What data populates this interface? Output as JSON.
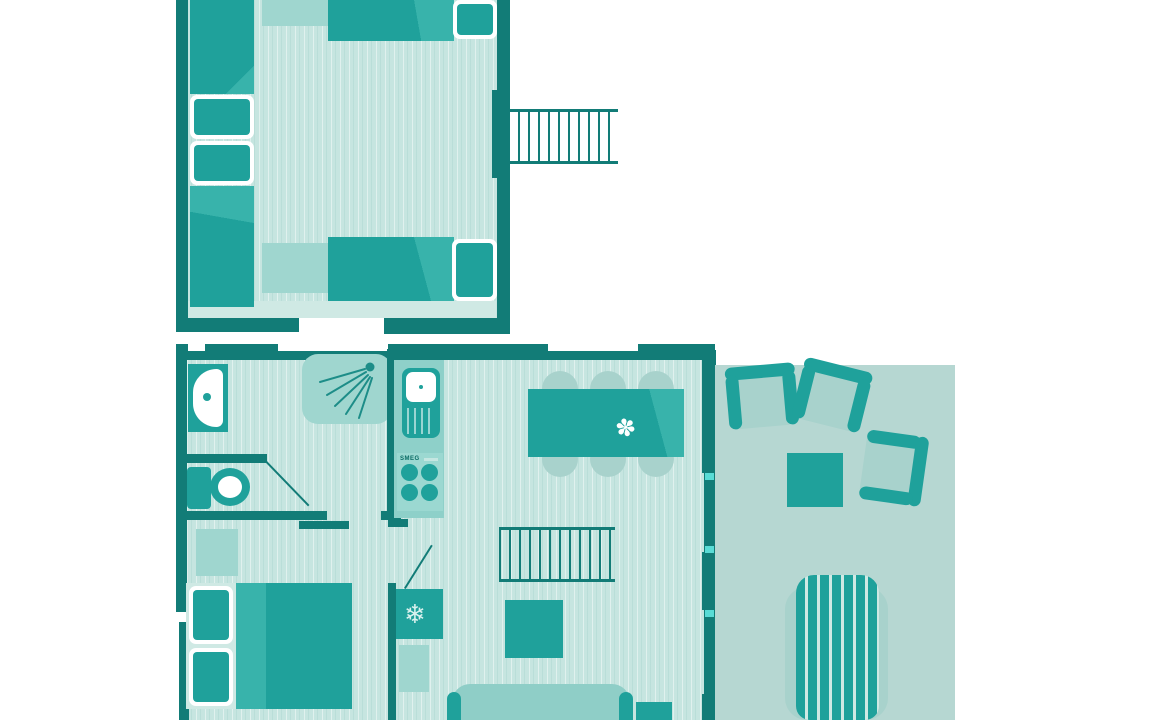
{
  "colors": {
    "wall": "#127c77",
    "furniture": "#1fa19b",
    "furniture_shade": "#38b3ab",
    "light_furniture": "#9fd6cf",
    "sofa_light": "#8fcec7",
    "counter": "#8ed0c9",
    "stove_panel": "#9bd8d1",
    "floor": "#c6e5e0",
    "floor_band": "#cfe9e4",
    "terrace": "#b6d7d2",
    "chair_halo": "#a8d2cc",
    "window_accent": "#59dcd6",
    "white": "#ffffff"
  },
  "kitchen": {
    "stove_brand": "SMEG"
  },
  "icons": {
    "snowflake_glyph": "❄",
    "flower_glyph": "✽",
    "shower_icon": "shower-spray",
    "sink_icon": "washbasin",
    "toilet_icon": "toilet",
    "stairs_icon": "stairs-rungs"
  }
}
